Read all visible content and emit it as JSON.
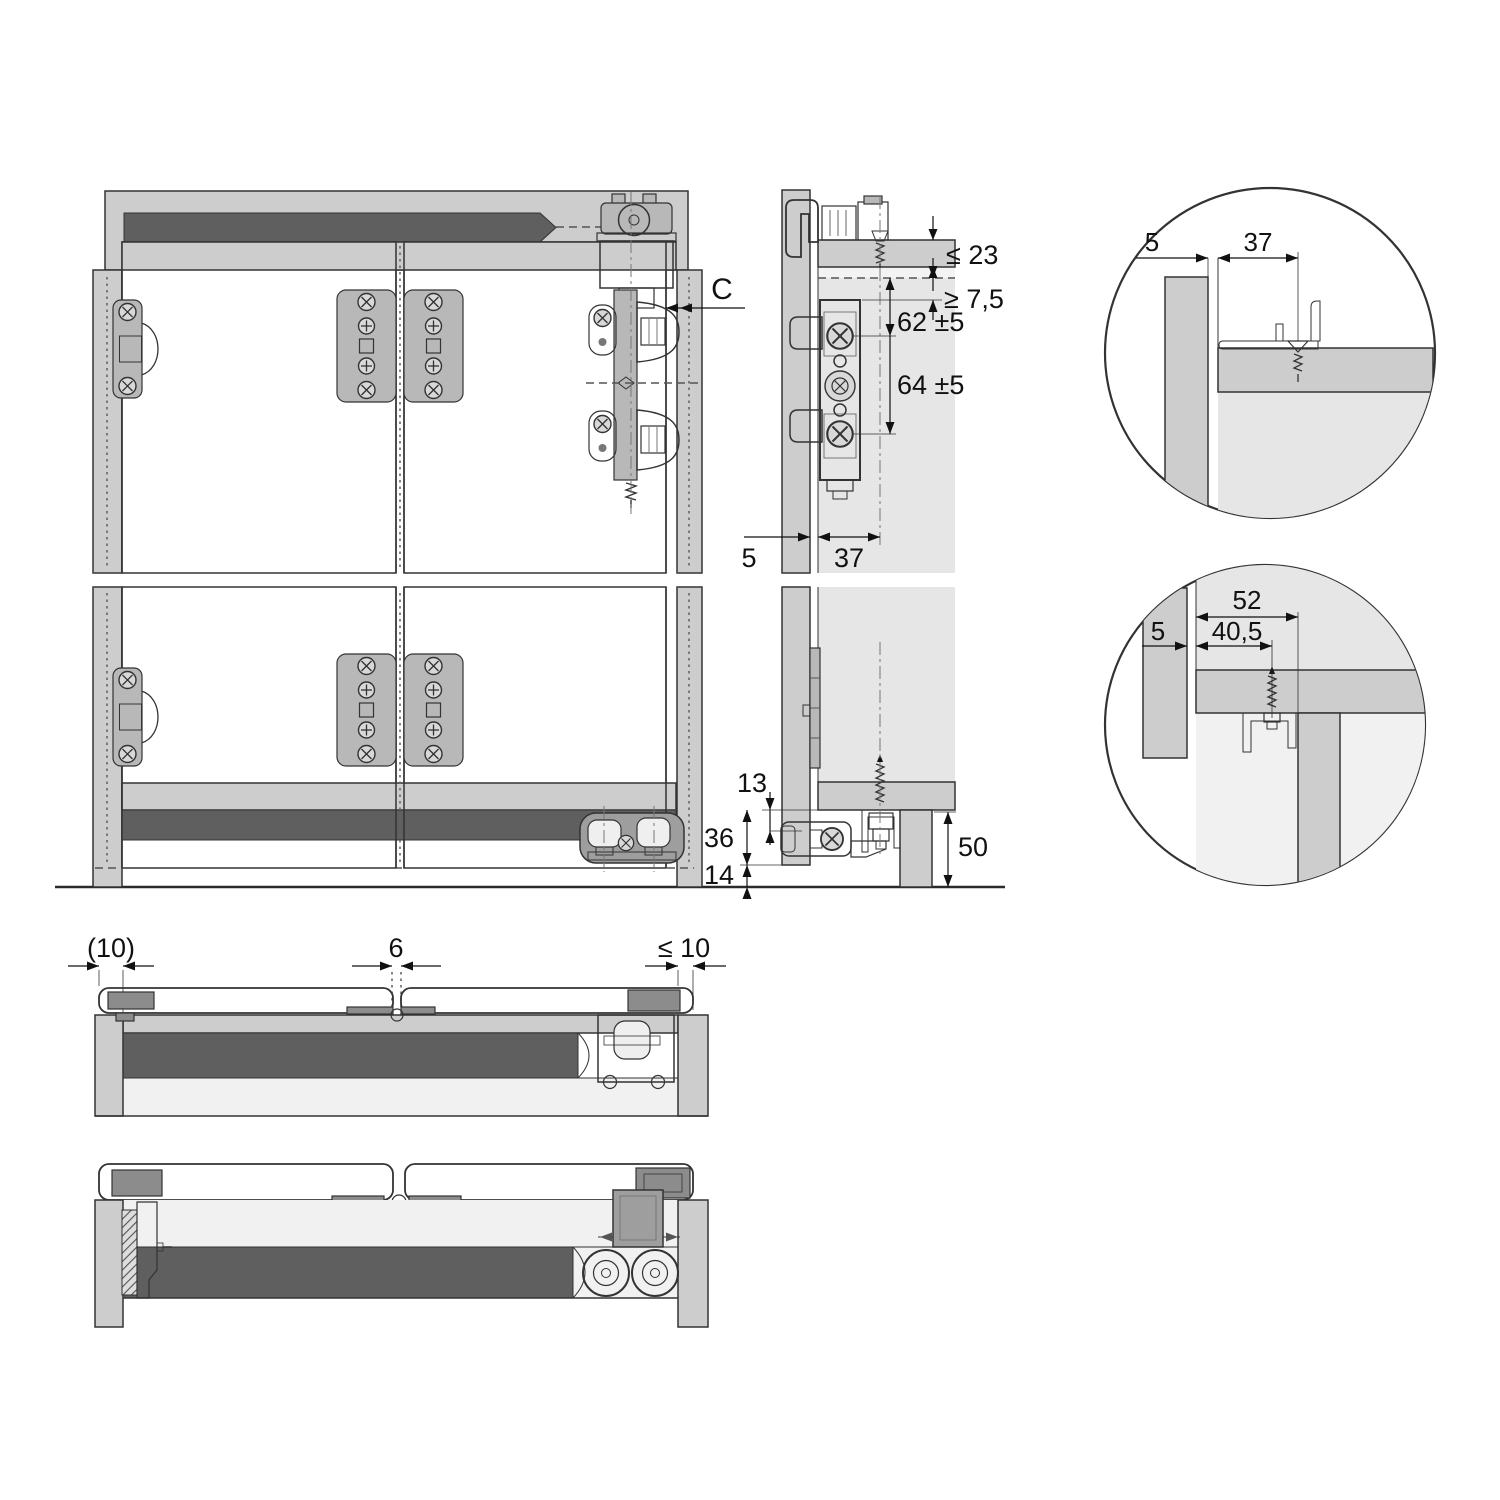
{
  "drawing_type": "sliding-door-hardware-installation-diagram",
  "dims": {
    "front_c": "C",
    "side_top_thickness": "≤ 23",
    "side_track_clearance": "≥ 7,5",
    "side_screw_spacing_upper": "62 ±5",
    "side_screw_spacing_lower": "64 ±5",
    "side_front_gap": "5",
    "side_screw_offset": "37",
    "side_bottom_track": "13",
    "side_bottom_bracket": "36",
    "side_floor_clearance": "14",
    "side_plinth_height": "50",
    "detail_top_gap": "5",
    "detail_top_screw_offset": "37",
    "detail_bottom_channel": "52",
    "detail_bottom_screw_offset": "40,5",
    "detail_bottom_gap": "5",
    "plan_side_overlay": "(10)",
    "plan_door_joint": "6",
    "plan_max_overlay": "≤ 10"
  },
  "colors": {
    "panel": "#cdcdcd",
    "interior": "#e6e6e6",
    "track_dark": "#5f5f5f",
    "hardware": "#9e9e9e",
    "door": "#ffffff",
    "outline": "#333333",
    "dim": "#111111"
  }
}
